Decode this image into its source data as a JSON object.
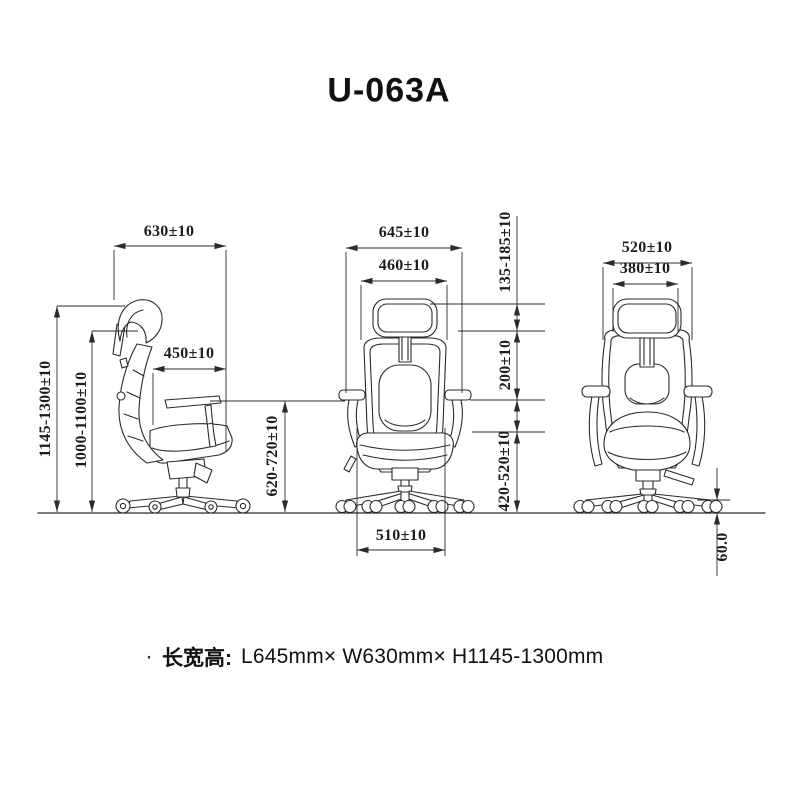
{
  "title": "U-063A",
  "dimensions": {
    "side": {
      "overall_depth": "630±10",
      "seat_depth": "450±10",
      "overall_height": "1145-1300±10",
      "back_height": "1000-1100±10",
      "armrest_height": "620-720±10"
    },
    "back": {
      "overall_width": "645±10",
      "backrest_width": "460±10",
      "headrest_adjust_range": "135-185±10",
      "backrest_span": "200±10",
      "seat_height_range": "420-520±10",
      "seat_width": "510±10"
    },
    "front": {
      "shoulder_width": "520±10",
      "headrest_width": "380±10",
      "caster_height": "60.0"
    }
  },
  "spec": {
    "bullet": "·",
    "label": "长宽高:",
    "value": "L645mm× W630mm× H1145-1300mm"
  },
  "colors": {
    "line": "#2b2b2b",
    "background": "#ffffff",
    "text": "#111111"
  }
}
